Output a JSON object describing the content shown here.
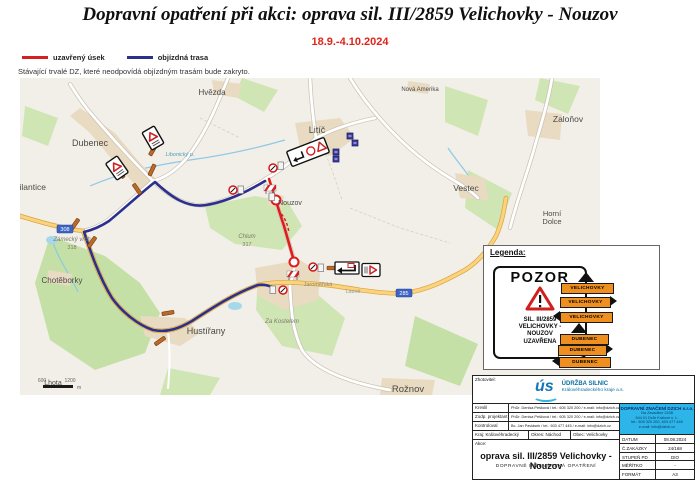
{
  "header": {
    "title": "Dopravní opatření při akci: oprava sil. III/2859 Velichovky - Nouzov",
    "date_range": "18.9.-4.10.2024",
    "closed_label": "uzavřený úsek",
    "detour_label": "objízdná trasa",
    "note": "Stávající trvalé DZ, které neodpovídá objízdným trasám bude zakryto.",
    "closed_color": "#d42020",
    "detour_color": "#2b2f8e"
  },
  "map": {
    "places": [
      {
        "name": "Dubenec"
      },
      {
        "name": "Hvězda"
      },
      {
        "name": "Litíč"
      },
      {
        "name": "Zaloňov"
      },
      {
        "name": "Vestec"
      },
      {
        "name": "Horní"
      },
      {
        "name": "Dolce"
      },
      {
        "name": "Nouzov"
      },
      {
        "name": "Vilantice"
      },
      {
        "name": "Chotěborky"
      },
      {
        "name": "Hustířany"
      },
      {
        "name": "Lhota"
      },
      {
        "name": "Rožnov"
      },
      {
        "name": "Nová Amerika"
      },
      {
        "name": "Za Kostelem"
      },
      {
        "name": "Zámecký vrch"
      },
      {
        "name": "318"
      },
      {
        "name": "Chlum"
      },
      {
        "name": "317"
      },
      {
        "name": "Jaroměřská"
      },
      {
        "name": "Lázně"
      },
      {
        "name": "Libonický p."
      }
    ],
    "road_badges": [
      {
        "label": "308"
      },
      {
        "label": "285"
      }
    ],
    "scale": {
      "t1": "600",
      "t2": "1200",
      "unit": "m"
    }
  },
  "legend_box": {
    "heading": "Legenda:",
    "pozor_sign": {
      "word": "POZOR",
      "lines": [
        "SIL. III/2859",
        "VELICHOVKY -",
        "NOUZOV",
        "UZAVŘENA"
      ]
    },
    "sign_color": "#ef8f1f",
    "direction_signs": [
      {
        "label": "VELICHOVKY",
        "dir": "up"
      },
      {
        "label": "VELICHOVKY",
        "dir": "right"
      },
      {
        "label": "VELICHOVKY",
        "dir": "left"
      },
      {
        "label": "DUBENEC",
        "dir": "up"
      },
      {
        "label": "DUBENEC",
        "dir": "right"
      },
      {
        "label": "DUBENEC",
        "dir": "left"
      }
    ]
  },
  "title_block": {
    "zhotovitel_label": "Zhotovitel:",
    "logo_text": "ús",
    "company_name": "ÚDRŽBA SILNIC",
    "company_sub": "Královéhradeckého kraje a.s.",
    "rows": [
      {
        "label": "Kreslil",
        "value": "PhDr. Denisa Pešková / tel.: 605 320 200 / e-mail: info@dzich.cz"
      },
      {
        "label": "Zodp. projektant",
        "value": "PhDr. Denisa Pešková / tel.: 605 320 200 / e-mail: info@dzich.cz"
      },
      {
        "label": "Kontroloval",
        "value": "Bc. Jan Pavlásek / tel.: 603 477 445 / e-mail: info@dzich.cz"
      }
    ],
    "region": {
      "kraj": "Kraj: Královéhradecký",
      "okres": "Okres: Náchod",
      "obec": "Obec: Velichovky"
    },
    "akce_label": "Akce:",
    "akce_title": "oprava sil. III/2859 Velichovky - Nouzov",
    "akce_sub": "DOPRAVNĚ INŽENÝRSKÁ OPATŘENÍ",
    "supplier_box": {
      "title": "DOPRAVNÍ ZNAČENÍ DZICH s.r.o.",
      "lines": [
        "Na Zavadilce 2438",
        "544 01 Dvůr Králové n. L.",
        "tel.: 605 320 200, 603 477 445",
        "e-mail: info@dzich.cz"
      ]
    },
    "meta": [
      {
        "label": "DATUM",
        "value": "08.08.2024"
      },
      {
        "label": "Č.ZAKÁZKY",
        "value": "24/168"
      },
      {
        "label": "STUPEŇ PD",
        "value": "DIO"
      },
      {
        "label": "MĚŘÍTKO",
        "value": "-"
      },
      {
        "label": "FORMÁT",
        "value": "A3"
      }
    ]
  }
}
